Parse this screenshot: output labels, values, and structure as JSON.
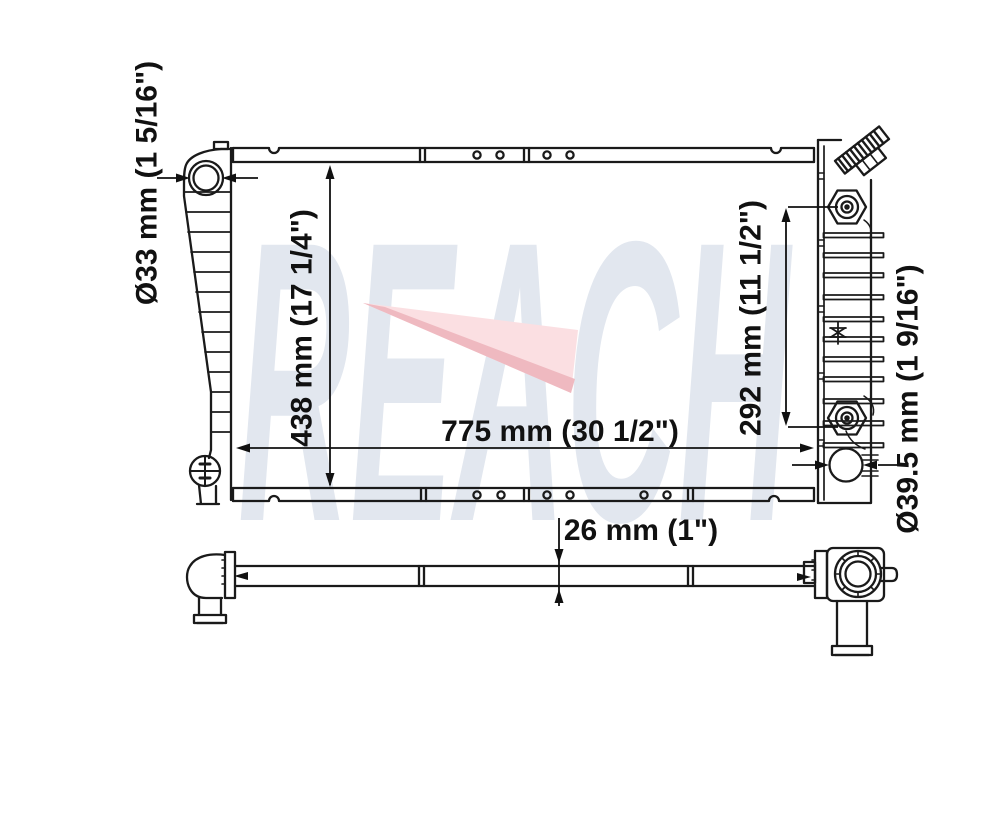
{
  "watermark": {
    "text": "REACH"
  },
  "labels": {
    "filler_neck": "Ø33 mm (1 5/16\")",
    "height": "438 mm (17 1/4\")",
    "width": "775 mm (30 1/2\")",
    "port_spacing": "292 mm (11 1/2\")",
    "outlet": "Ø39.5 mm (1 9/16\")",
    "thickness": "26 mm (1\")"
  },
  "colors": {
    "line": "#1a1a1a",
    "dimension": "#111111",
    "watermark_text": "#e2e7ef",
    "swoosh_light": "#fbdfe2",
    "swoosh_dark": "#efb9c0"
  }
}
